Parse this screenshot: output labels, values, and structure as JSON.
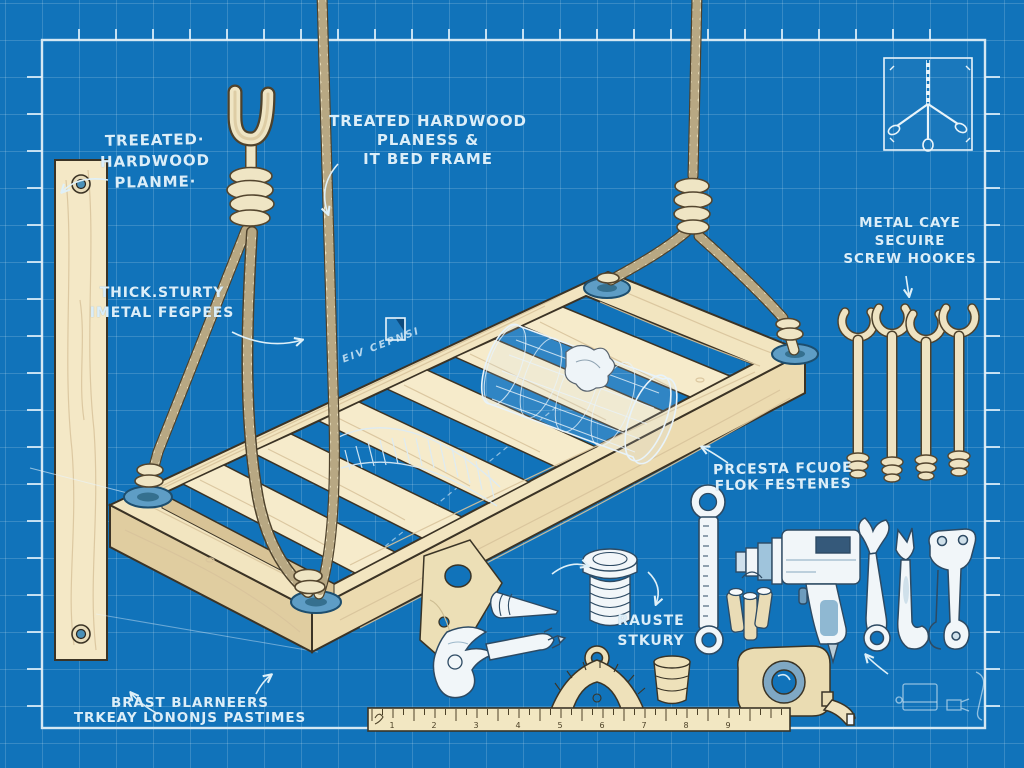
{
  "scene": {
    "type": "blueprint assembly diagram",
    "subject": "Hanging rope bed frame with hardware and tools"
  },
  "colors": {
    "background": "#1173ba",
    "grid_line": "rgba(255,255,255,0.16)",
    "border": "#d5e8f3",
    "wood": "#f2e5c0",
    "rope": "#efe5c4",
    "washer": "#5e9dc5",
    "tool_white": "#f1f6f9",
    "label_text": "#dbeef9"
  },
  "labels": {
    "plank": {
      "lines": [
        "TREEATED·",
        "HARDWOOD",
        "PLANME·"
      ]
    },
    "bed_frame": {
      "lines": [
        "TREATED HARDWOOD",
        "PLANESS &",
        "IT BED FRAME"
      ]
    },
    "rope": {
      "lines": [
        "THICK.STURTY",
        "IMETAL FEGPEES"
      ]
    },
    "screw_hooks": {
      "lines": [
        "METAL CAYE",
        "SECUIRE",
        "SCREW HOOKES"
      ]
    },
    "fasteners": {
      "lines": [
        "PRCESTA FCUOE",
        "FLOK FESTENES"
      ]
    },
    "bolt": {
      "lines": [
        "RAUSTE",
        "STKURY"
      ]
    },
    "hardware": {
      "lines": [
        "BRAST BLARNEERS",
        "TRKEAY LONONJS PASTIMES"
      ]
    },
    "watermark": "EIV CEPNSI"
  },
  "ruler": {
    "numbers": [
      "1",
      "2",
      "3",
      "4",
      "5",
      "6",
      "7",
      "8",
      "9"
    ]
  },
  "illustrations": [
    "wood-plank",
    "suspension-hook",
    "rope-knots",
    "bed-frame",
    "wire-cage",
    "mesh-arc",
    "corner-washers",
    "corner-bracket",
    "screw-hooks",
    "detail-inset",
    "box-wrench",
    "drill",
    "bit-bundle",
    "open-wrench",
    "hook-wrench",
    "bone-wrench",
    "claw-tool",
    "cone-tip",
    "threaded-bolt",
    "protractor",
    "thimble",
    "tape-measure",
    "ruler",
    "sketch-doodles"
  ]
}
